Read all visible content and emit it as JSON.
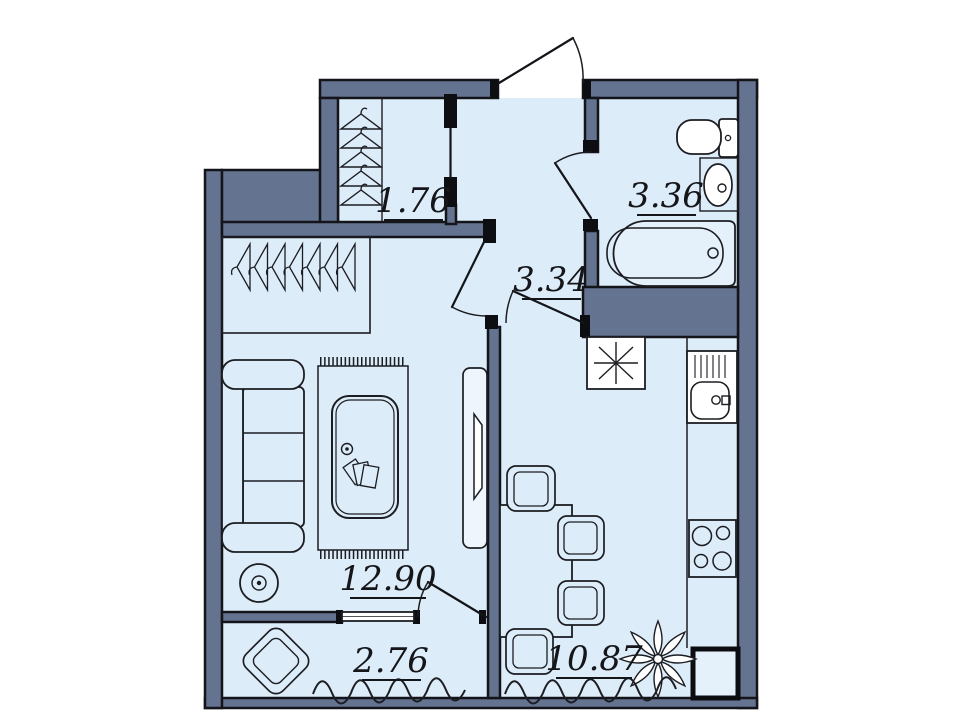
{
  "plan": {
    "type": "apartment-floor-plan",
    "colors": {
      "wall": "#64738f",
      "floor": "#dcecf8",
      "outline": "#14151a",
      "paper": "#ffffff"
    },
    "rooms": [
      {
        "name": "wardrobe",
        "area": "1.76",
        "fixtures": [
          "clothes-hangers"
        ],
        "hanger_count": 5
      },
      {
        "name": "hallway",
        "area": "3.34",
        "fixtures": [
          "entry-door",
          "interior-doors"
        ]
      },
      {
        "name": "bathroom",
        "area": "3.36",
        "fixtures": [
          "toilet",
          "wash-basin",
          "bathtub"
        ]
      },
      {
        "name": "living-room",
        "area": "12.90",
        "fixtures": [
          "coat-rail",
          "sofa",
          "rug",
          "coffee-table",
          "floor-lamp",
          "tv-stand",
          "balcony-window",
          "balcony-door"
        ],
        "coat_hanger_count": 7
      },
      {
        "name": "balcony",
        "area": "2.76",
        "fixtures": [
          "armchair"
        ]
      },
      {
        "name": "kitchen",
        "area": "10.87",
        "fixtures": [
          "ventilation-shaft",
          "kitchen-sink",
          "counter",
          "stove",
          "dining-table",
          "chairs",
          "plant"
        ],
        "chair_count": 4,
        "stove_burner_count": 4
      }
    ]
  }
}
